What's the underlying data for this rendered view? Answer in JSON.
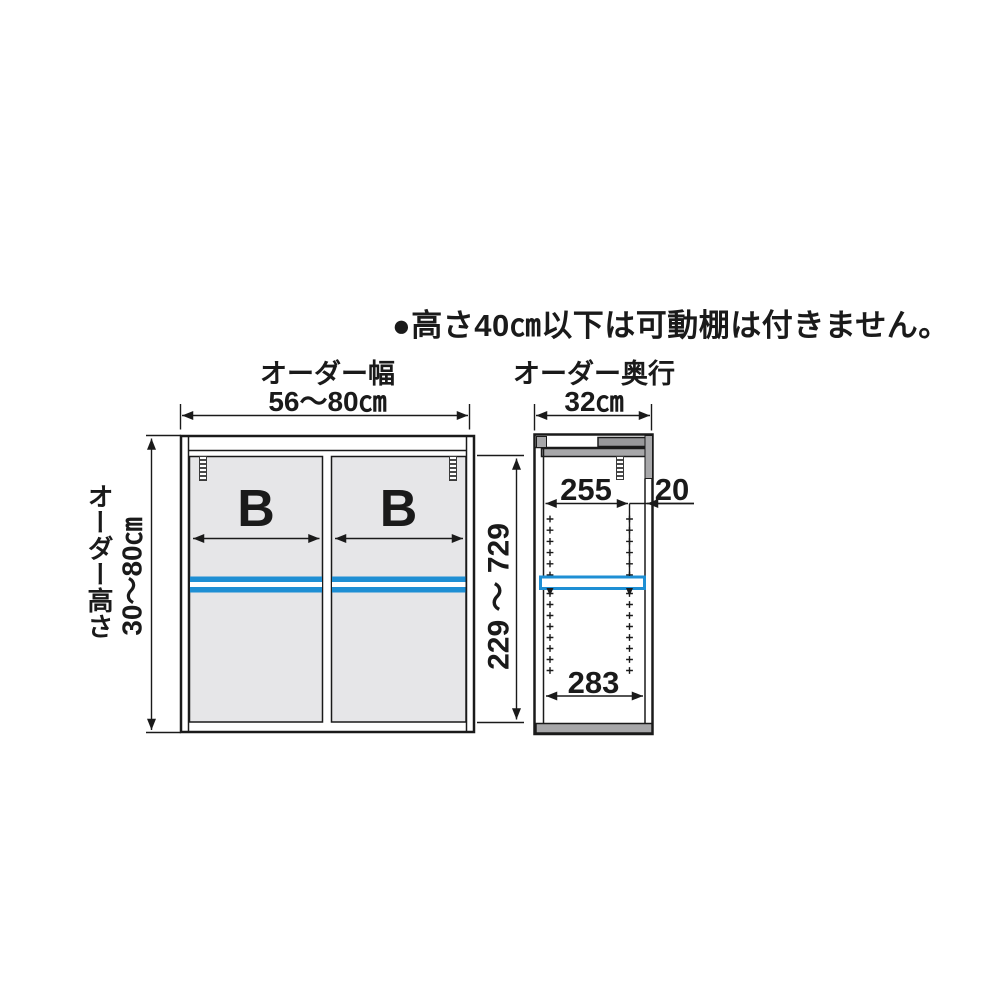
{
  "note": {
    "text": "●高さ40㎝以下は可動棚は付きません。"
  },
  "front_view": {
    "width_title": "オーダー幅",
    "width_value": "56〜80㎝",
    "height_title": "オーダー高さ",
    "height_value": "30〜80㎝",
    "inner_height_value": "229 〜 729",
    "left_door_label": "B",
    "right_door_label": "B"
  },
  "side_view": {
    "depth_title": "オーダー奥行",
    "depth_value": "32㎝",
    "shelf_depth_value": "255",
    "front_clearance_value": "20",
    "inner_depth_value": "283"
  },
  "colors": {
    "shelf_highlight_blue": "#1e8fd4",
    "line_black": "#1a1a1a",
    "door_gray": "#e6e6e8",
    "frame_gray": "#a7a7a9"
  }
}
